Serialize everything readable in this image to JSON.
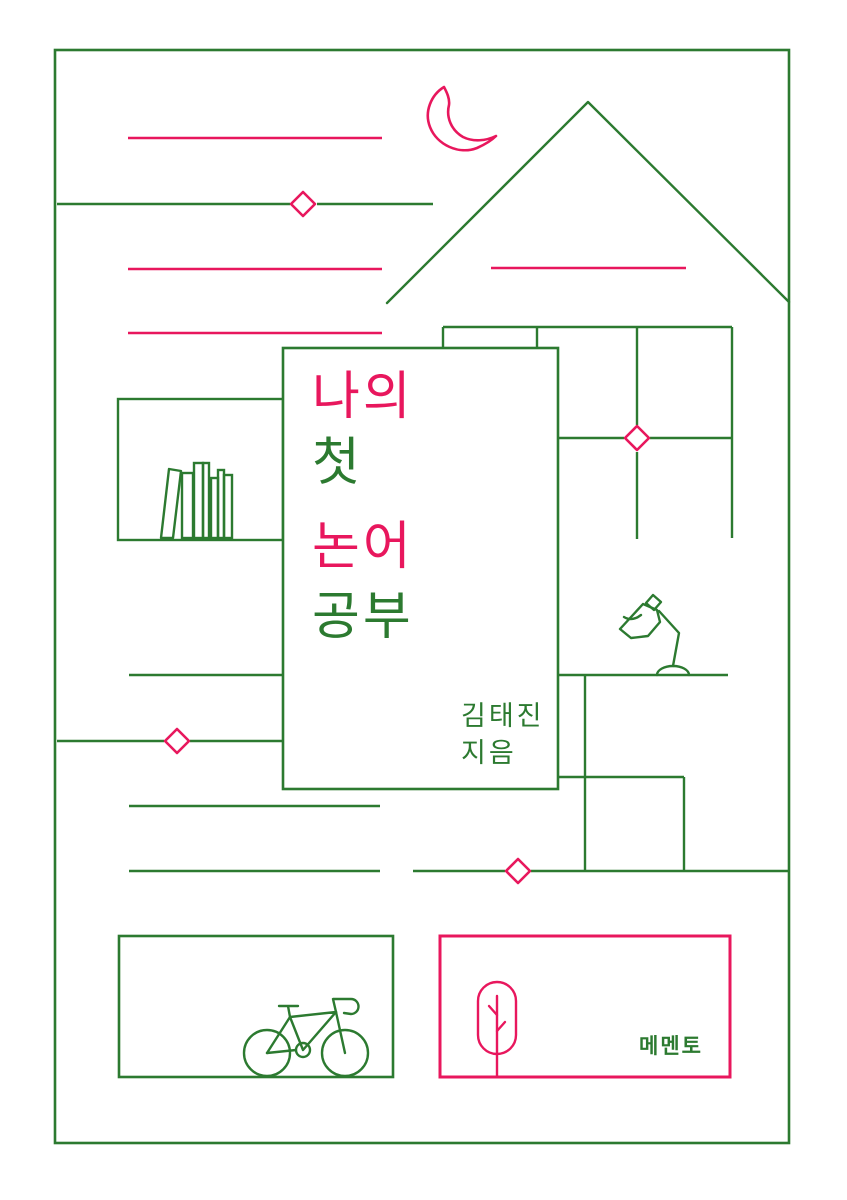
{
  "meta": {
    "kind": "book-cover-illustration"
  },
  "colors": {
    "green": "#2c7a30",
    "pink": "#e8175d",
    "paper": "#ffffff"
  },
  "title": {
    "lines": [
      {
        "text": "나의",
        "color": "pink"
      },
      {
        "text": "첫",
        "color": "green"
      },
      {
        "text": "논어",
        "color": "pink"
      },
      {
        "text": "공부",
        "color": "green"
      }
    ]
  },
  "author": {
    "name": "김태진",
    "role": "지음"
  },
  "publisher": {
    "logo": "메멘토"
  },
  "icons": {
    "moon": "crescent-moon",
    "house": "house-roof-outline",
    "window": "window-grid",
    "bookshelf": "books-on-shelf",
    "lamp": "desk-lamp",
    "bed": "bedside-table",
    "bicycle": "bicycle",
    "tree": "tree-in-capsule",
    "diamond": "diamond-accent"
  }
}
